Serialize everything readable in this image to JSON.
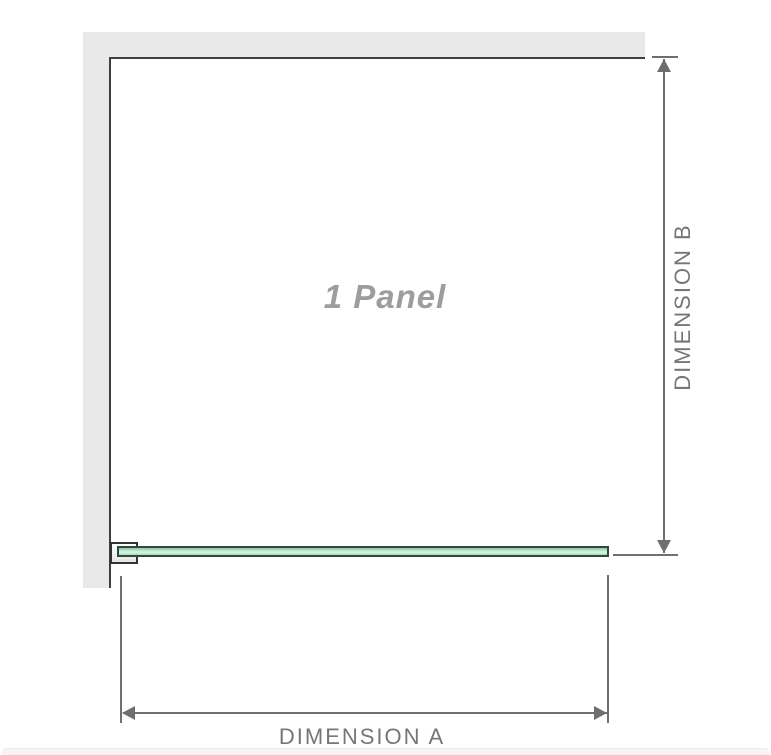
{
  "diagram": {
    "title": "1 Panel",
    "dim_a": {
      "label": "DIMENSION A"
    },
    "dim_b": {
      "label": "DIMENSION B"
    },
    "colors": {
      "wall": "#e9e9e9",
      "edge": "#3f3f3f",
      "dim_line": "#6f6f6f",
      "dim_text": "#767676",
      "panel_text": "#9d9d9d",
      "glass_border": "#2d4a3a",
      "glass_top": "#86c5a3",
      "glass_mid": "#ddf2e7",
      "glass_bottom": "#a9dabf",
      "bracket_fill": "#e6e6e6",
      "bottom_band": "#f6f4f4"
    }
  }
}
